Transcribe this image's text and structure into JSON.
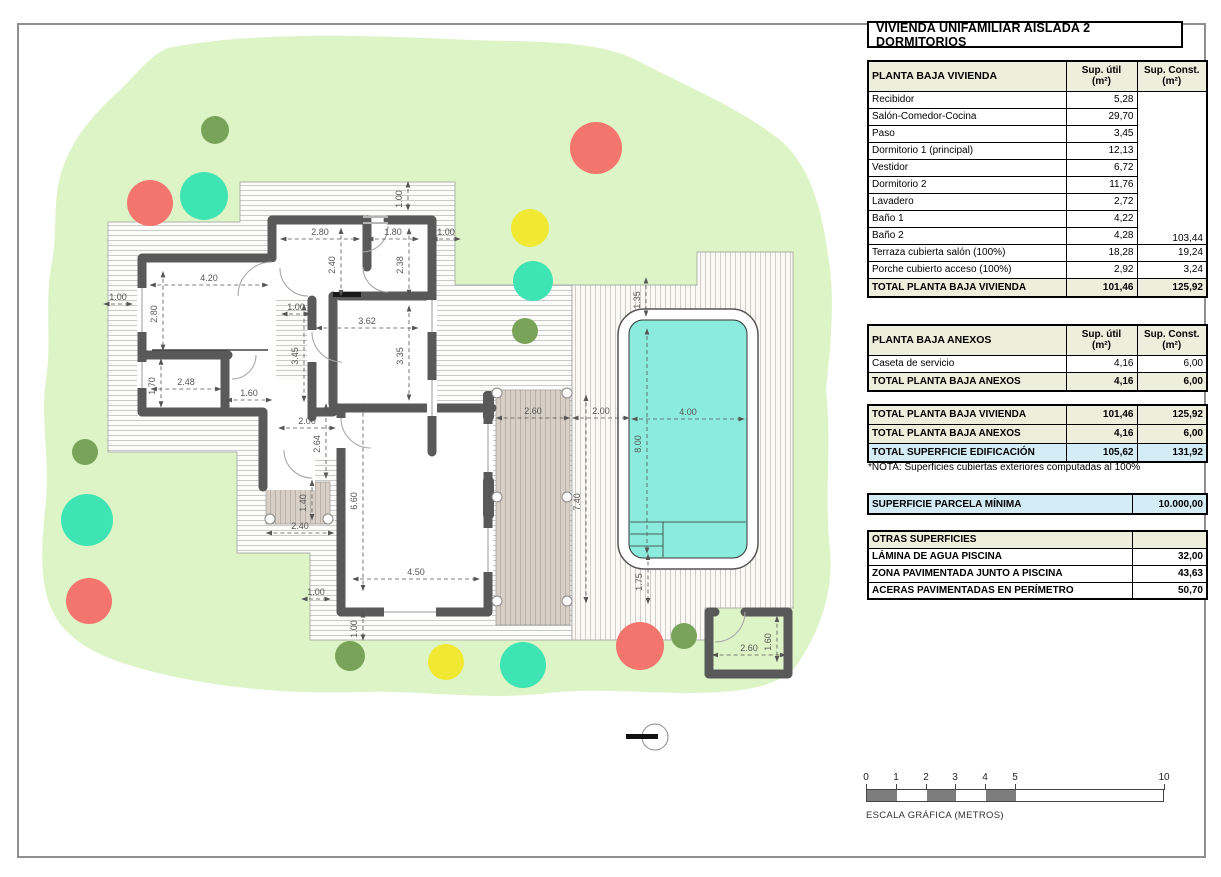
{
  "title": "VIVIENDA UNIFAMILIAR AISLADA 2 DORMITORIOS",
  "tables": {
    "vivienda": {
      "title": "PLANTA BAJA VIVIENDA",
      "col_util": [
        "Sup. útil",
        "(m²)"
      ],
      "col_const": [
        "Sup. Const.",
        "(m²)"
      ],
      "rows_merged": [
        [
          "Recibidor",
          "5,28"
        ],
        [
          "Salón-Comedor-Cocina",
          "29,70"
        ],
        [
          "Paso",
          "3,45"
        ],
        [
          "Dormitorio 1 (principal)",
          "12,13"
        ],
        [
          "Vestidor",
          "6,72"
        ],
        [
          "Dormitorio 2",
          "11,76"
        ],
        [
          "Lavadero",
          "2,72"
        ],
        [
          "Baño 1",
          "4,22"
        ],
        [
          "Baño 2",
          "4,28"
        ]
      ],
      "merged_const": "103,44",
      "rows_rest": [
        [
          "Terraza cubierta salón (100%)",
          "18,28",
          "19,24"
        ],
        [
          "Porche cubierto acceso (100%)",
          "2,92",
          "3,24"
        ]
      ],
      "total": [
        "TOTAL PLANTA BAJA VIVIENDA",
        "101,46",
        "125,92"
      ]
    },
    "anexos": {
      "title": "PLANTA BAJA ANEXOS",
      "col_util": [
        "Sup. útil",
        "(m²)"
      ],
      "col_const": [
        "Sup. Const.",
        "(m²)"
      ],
      "rows": [
        [
          "Caseta de servicio",
          "4,16",
          "6,00"
        ]
      ],
      "total": [
        "TOTAL PLANTA BAJA ANEXOS",
        "4,16",
        "6,00"
      ]
    },
    "resumen": {
      "rows": [
        {
          "label": "TOTAL PLANTA BAJA VIVIENDA",
          "util": "101,46",
          "const": "125,92",
          "style": "beige"
        },
        {
          "label": "TOTAL PLANTA BAJA ANEXOS",
          "util": "4,16",
          "const": "6,00",
          "style": "beige"
        },
        {
          "label": "TOTAL SUPERFICIE EDIFICACIÓN",
          "util": "105,62",
          "const": "131,92",
          "style": "blue"
        }
      ]
    },
    "nota": "*NOTA: Superficies cubiertas exteriores computadas al 100%",
    "parcela": {
      "label": "SUPERFICIE PARCELA MÍNIMA",
      "value": "10.000,00"
    },
    "otras": {
      "title": "OTRAS SUPERFICIES",
      "rows": [
        [
          "LÁMINA DE AGUA PISCINA",
          "32,00"
        ],
        [
          "ZONA PAVIMENTADA JUNTO A PISCINA",
          "43,63"
        ],
        [
          "ACERAS PAVIMENTADAS EN PERÍMETRO",
          "50,70"
        ]
      ]
    }
  },
  "scale_bar": {
    "caption": "ESCALA GRÁFICA (METROS)",
    "ticks": [
      {
        "label": "0",
        "m": 0
      },
      {
        "label": "1",
        "m": 1
      },
      {
        "label": "2",
        "m": 2
      },
      {
        "label": "3",
        "m": 3
      },
      {
        "label": "4",
        "m": 4
      },
      {
        "label": "5",
        "m": 5
      },
      {
        "label": "10",
        "m": 10
      }
    ],
    "meter_px": 29.8,
    "filled_segments": [
      [
        0,
        1
      ],
      [
        2,
        3
      ],
      [
        4,
        5
      ]
    ]
  },
  "plan": {
    "colors": {
      "garden": "#ddf4c6",
      "wall": "#595959",
      "pool_water": "#8bebdd",
      "terrace": "#d8cfc7",
      "tree_red": "#f4756d",
      "tree_teal": "#3fe4b4",
      "tree_yellow": "#f0e832",
      "tree_olive": "#79a359"
    },
    "dimensions": [
      {
        "t": "1.00",
        "x": 403,
        "y": 196,
        "r": 1
      },
      {
        "t": "2.80",
        "x": 320,
        "y": 234,
        "r": 0
      },
      {
        "t": "1.80",
        "x": 393,
        "y": 234,
        "r": 0
      },
      {
        "t": "1.00",
        "x": 446,
        "y": 234,
        "r": 0
      },
      {
        "t": "2.40",
        "x": 336,
        "y": 262,
        "r": 1
      },
      {
        "t": "2.38",
        "x": 404,
        "y": 262,
        "r": 1
      },
      {
        "t": "4.20",
        "x": 209,
        "y": 280,
        "r": 0
      },
      {
        "t": "1.00",
        "x": 118,
        "y": 299,
        "r": 0
      },
      {
        "t": "2.80",
        "x": 158,
        "y": 311,
        "r": 1
      },
      {
        "t": "1.00",
        "x": 296,
        "y": 309,
        "r": 0
      },
      {
        "t": "3.62",
        "x": 367,
        "y": 323,
        "r": 0
      },
      {
        "t": "3.45",
        "x": 299,
        "y": 353,
        "r": 1
      },
      {
        "t": "3.35",
        "x": 404,
        "y": 353,
        "r": 1
      },
      {
        "t": "1.70",
        "x": 156,
        "y": 383,
        "r": 1
      },
      {
        "t": "2.48",
        "x": 186,
        "y": 384,
        "r": 0
      },
      {
        "t": "1.60",
        "x": 249,
        "y": 395,
        "r": 0
      },
      {
        "t": "2.00",
        "x": 307,
        "y": 423,
        "r": 0
      },
      {
        "t": "2.64",
        "x": 321,
        "y": 441,
        "r": 1
      },
      {
        "t": "1.40",
        "x": 307,
        "y": 500,
        "r": 1
      },
      {
        "t": "2.40",
        "x": 300,
        "y": 528,
        "r": 0
      },
      {
        "t": "6.60",
        "x": 358,
        "y": 498,
        "r": 1
      },
      {
        "t": "4.50",
        "x": 416,
        "y": 574,
        "r": 0
      },
      {
        "t": "1.00",
        "x": 316,
        "y": 594,
        "r": 0
      },
      {
        "t": "1.00",
        "x": 358,
        "y": 626,
        "r": 1
      },
      {
        "t": "2.60",
        "x": 533,
        "y": 413,
        "r": 0
      },
      {
        "t": "2.00",
        "x": 601,
        "y": 413,
        "r": 0
      },
      {
        "t": "7.40",
        "x": 581,
        "y": 499,
        "r": 1
      },
      {
        "t": "1.35",
        "x": 641,
        "y": 297,
        "r": 1
      },
      {
        "t": "4.00",
        "x": 688,
        "y": 414,
        "r": 0
      },
      {
        "t": "8.00",
        "x": 642,
        "y": 441,
        "r": 1
      },
      {
        "t": "1.75",
        "x": 643,
        "y": 579,
        "r": 1
      },
      {
        "t": "2.60",
        "x": 749,
        "y": 650,
        "r": 0
      },
      {
        "t": "1.60",
        "x": 772,
        "y": 639,
        "r": 1
      }
    ],
    "trees": [
      {
        "c": "tree_olive",
        "x": 215,
        "y": 130,
        "rad": 14
      },
      {
        "c": "tree_red",
        "x": 150,
        "y": 203,
        "rad": 23
      },
      {
        "c": "tree_teal",
        "x": 204,
        "y": 196,
        "rad": 24
      },
      {
        "c": "tree_red",
        "x": 596,
        "y": 148,
        "rad": 26
      },
      {
        "c": "tree_yellow",
        "x": 530,
        "y": 228,
        "rad": 19
      },
      {
        "c": "tree_teal",
        "x": 533,
        "y": 281,
        "rad": 20
      },
      {
        "c": "tree_olive",
        "x": 525,
        "y": 331,
        "rad": 13
      },
      {
        "c": "tree_olive",
        "x": 85,
        "y": 452,
        "rad": 13
      },
      {
        "c": "tree_teal",
        "x": 87,
        "y": 520,
        "rad": 26
      },
      {
        "c": "tree_red",
        "x": 89,
        "y": 601,
        "rad": 23
      },
      {
        "c": "tree_olive",
        "x": 350,
        "y": 656,
        "rad": 15
      },
      {
        "c": "tree_yellow",
        "x": 446,
        "y": 662,
        "rad": 18
      },
      {
        "c": "tree_teal",
        "x": 523,
        "y": 665,
        "rad": 23
      },
      {
        "c": "tree_red",
        "x": 640,
        "y": 646,
        "rad": 24
      },
      {
        "c": "tree_olive",
        "x": 684,
        "y": 636,
        "rad": 13
      }
    ]
  }
}
